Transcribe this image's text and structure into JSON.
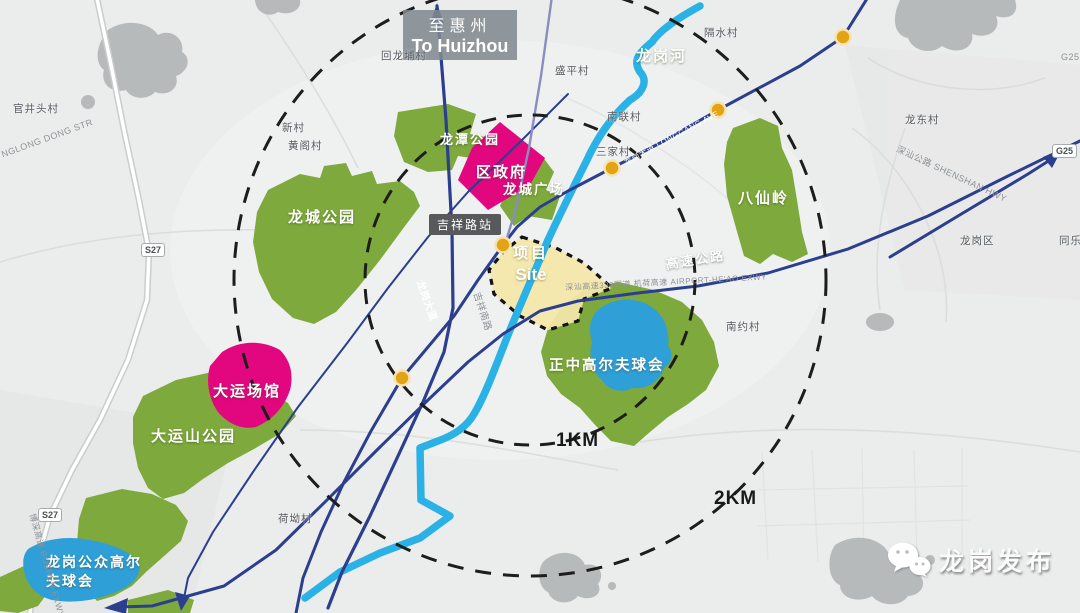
{
  "colors": {
    "background": "#ebecec",
    "terrain_gray": "#b6baba",
    "park_green": "#7ea93c",
    "venue_magenta": "#e2077f",
    "river_cyan": "#2ab2e7",
    "lake_blue": "#2f9fd8",
    "road_navy": "#2b3f8e",
    "rail_purple": "#8a8dc0",
    "station_amber": "#e2a414",
    "site_yellow": "#f4e7aa",
    "dash_black": "#1d1d1d"
  },
  "map": {
    "to_huizhou": {
      "zh": "至惠州",
      "en": "To Huizhou"
    },
    "river_label": "龙岗河",
    "expressway_label": "高速公路",
    "expressway_small_label": "深汕高速330国道 机荷高速 AIRPORT-HE'AO EXWY",
    "radius": {
      "inner": "1KM",
      "outer": "2KM"
    },
    "station_label": "吉祥路站",
    "site": {
      "zh": "项目",
      "en": "Site"
    },
    "areas": {
      "longtan_park": "龙潭公园",
      "district_government": "区政府",
      "longcheng_square": "龙城广场",
      "longcheng_park": "龙城公园",
      "baxianling": "八仙岭",
      "zhengzhong_golf": "正中高尔夫球会",
      "universiade_venues": "大运场馆",
      "dayunshan_park": "大运山公园",
      "longgang_public_golf": "龙岗公众高尔夫球会"
    },
    "villages": {
      "guanjingtou": "官井头村",
      "xincun": "新村",
      "huangge": "黄阁村",
      "huilongpu": "回龙埔村",
      "shengping": "盛平村",
      "geshui": "隔水村",
      "nanlian": "南联村",
      "sanjia": "三家村",
      "longdong": "龙东村",
      "nanyue": "南约村",
      "heao": "荷坳村",
      "longgang_district": "龙岗区",
      "tongle": "同乐"
    },
    "road_labels": {
      "longgang_ave_cn": "龙岗大道",
      "jixiang_south_rd": "吉祥南路",
      "longgang_ave_en": "龙岗大道 LONGGANG AVE",
      "shenshan_hwy": "深汕公路 SHENSHAN HWY",
      "dong_str": "NGLONG DONG STR",
      "boshen_exwy": "博深高速 BOSHEN EXWY",
      "s27": "S27",
      "g25": "G25"
    },
    "watermark": "龙岗发布"
  }
}
